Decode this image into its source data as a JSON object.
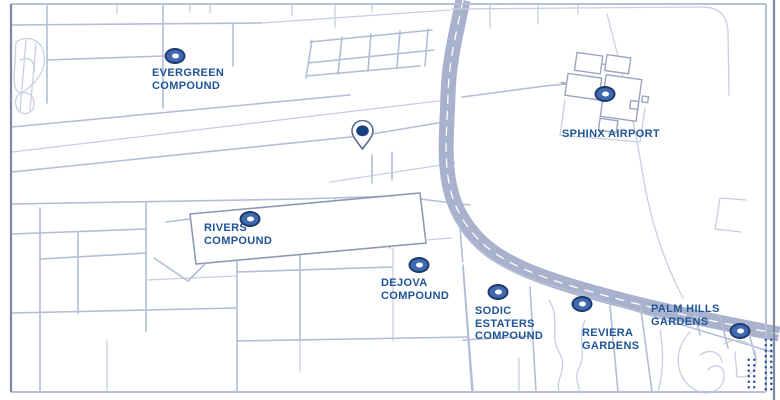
{
  "map": {
    "type": "stylized-area-map",
    "colors": {
      "road": "#b3bdd6",
      "road_light": "#c7cfe2",
      "frame_light": "#b7c0d6",
      "frame_dark": "#7e88a3",
      "highway": "#a8b2cc",
      "highway_center_line": "#ffffff",
      "building": "#9aa4c0",
      "label_text": "#1f5496",
      "marker_ring": "#3f6ab0",
      "marker_edge": "#1d3a6b",
      "marker_center": "#ffffff",
      "pin_fill": "#ffffff",
      "pin_border": "#5a6d94",
      "pin_dot": "#17417e",
      "dots": "#2d5a9e"
    },
    "locations": [
      {
        "name": "Evergreen Compound",
        "lines": [
          "EVERGREEN",
          "COMPOUND"
        ]
      },
      {
        "name": "Sphinx Airport",
        "lines": [
          "SPHINX AIRPORT"
        ]
      },
      {
        "name": "Rivers Compound",
        "lines": [
          "RIVERS",
          "COMPOUND"
        ]
      },
      {
        "name": "Dejova Compound",
        "lines": [
          "DEJOVA",
          "COMPOUND"
        ]
      },
      {
        "name": "Sodic Estaters Compound",
        "lines": [
          "SODIC",
          "ESTATERS",
          "COMPOUND"
        ]
      },
      {
        "name": "Reviera Gardens",
        "lines": [
          "REVIERA",
          "GARDENS"
        ]
      },
      {
        "name": "Palm Hills Gardens",
        "lines": [
          "PALM HILLS",
          "GARDENS"
        ]
      }
    ],
    "selected_pin": {
      "name": "Selected location pin"
    }
  }
}
